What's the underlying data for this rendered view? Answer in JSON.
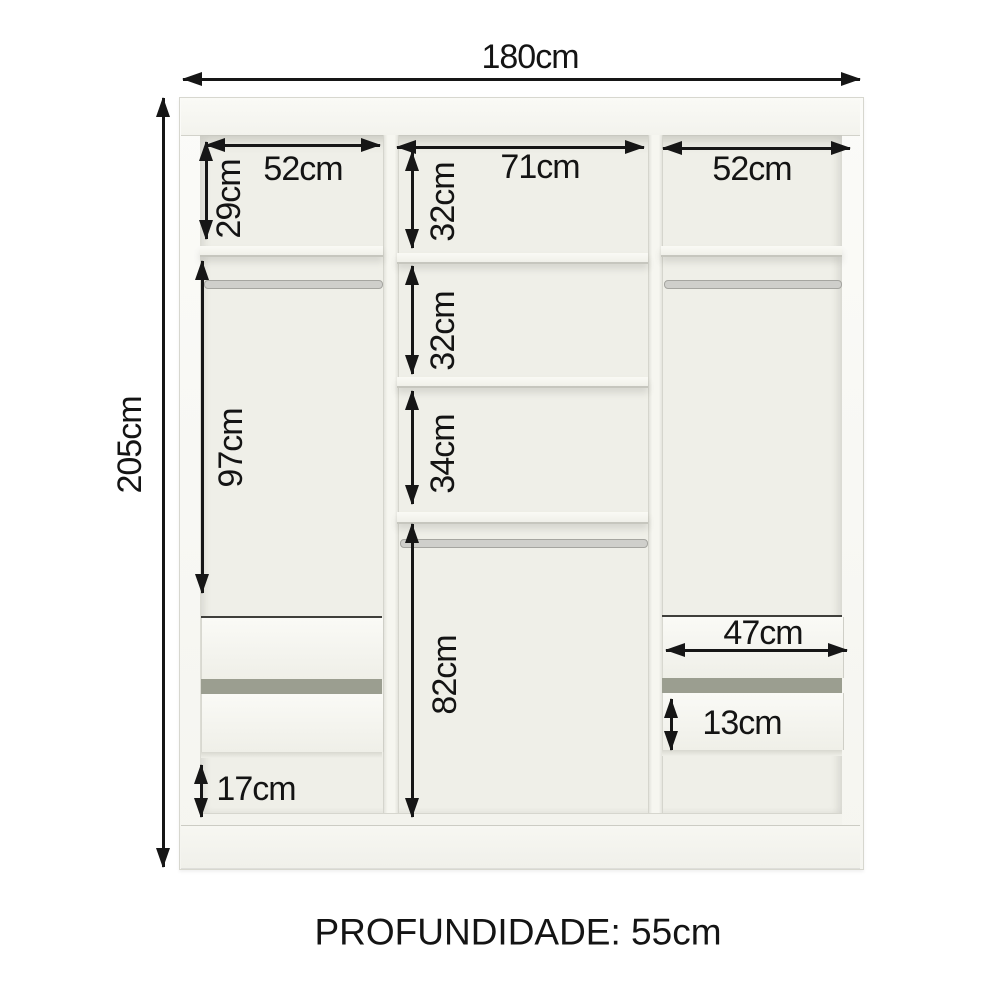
{
  "diagram_type": "wardrobe-internal-dimensions",
  "colors": {
    "line": "#161616",
    "cabinet": "#f6f6f1",
    "interior": "#efefe8",
    "drawer_gap": "#9b9e90"
  },
  "dims": {
    "total_width": "180cm",
    "total_height": "205cm",
    "left_col_width": "52cm",
    "mid_col_width": "71cm",
    "right_col_width": "52cm",
    "left_top_height": "29cm",
    "left_hanging_height": "97cm",
    "left_bottom_gap": "17cm",
    "mid_sec1_height": "32cm",
    "mid_sec2_height": "32cm",
    "mid_sec3_height": "34cm",
    "mid_lower_height": "82cm",
    "right_drawer_width": "47cm",
    "right_drawer_face_height": "13cm",
    "depth": "PROFUNDIDADE: 55cm"
  }
}
